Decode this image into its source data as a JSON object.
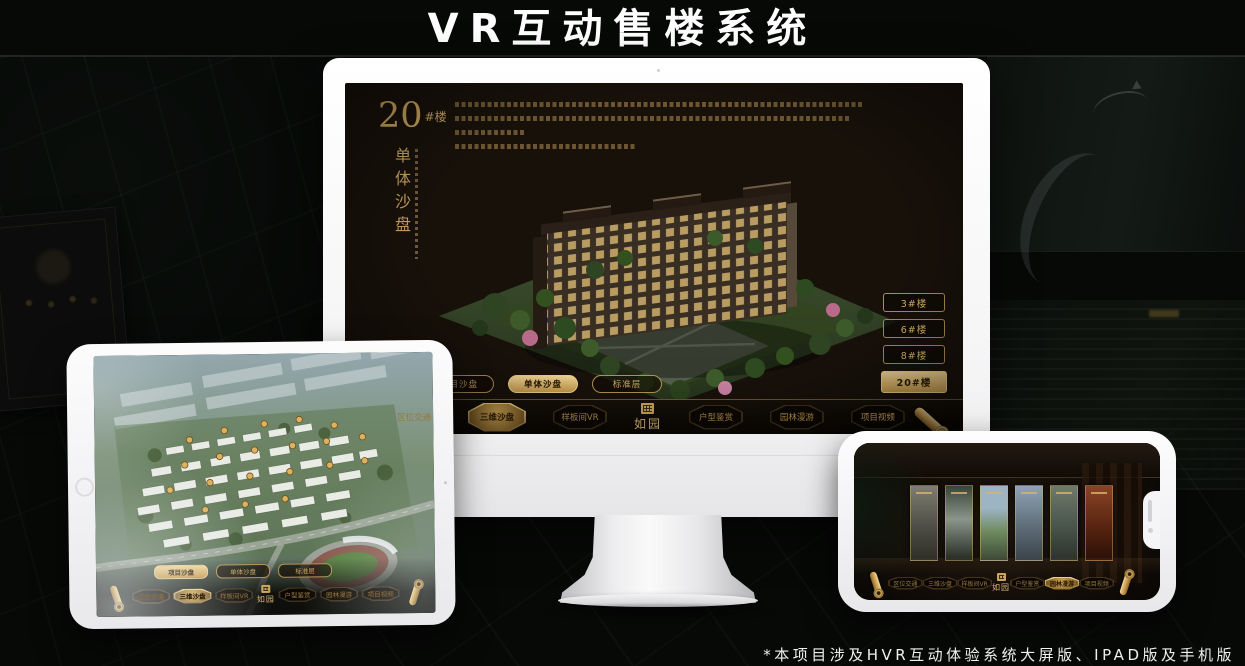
{
  "page": {
    "title": "VR互动售楼系统",
    "footnote": "*本项目涉及HVR互动体验系统大屏版、IPAD版及手机版"
  },
  "colors": {
    "gold": "#c9a45f",
    "gold_bright": "#ecd28c",
    "selected_gold_bg": "#d9b469",
    "screen_bg": "#18110a",
    "title_text": "#ffffff"
  },
  "icons": {
    "nav_end": "scroll-icon",
    "logo": "seal-icon",
    "tablet_home": "home-button",
    "camera": "camera-dot",
    "notch_speaker": "speaker-slit"
  },
  "desktop_screen": {
    "building_number": "20",
    "building_number_suffix": "#楼",
    "vertical_title": "单体沙盘",
    "building_buttons": [
      {
        "label": "3#楼"
      },
      {
        "label": "6#楼"
      },
      {
        "label": "8#楼"
      },
      {
        "label": "20#楼",
        "selected": true
      }
    ],
    "sub_tabs": [
      {
        "label": "项目沙盘"
      },
      {
        "label": "单体沙盘",
        "selected": true
      },
      {
        "label": "标准层"
      }
    ],
    "nav": {
      "logo": "如园",
      "items": [
        {
          "label": "区位交通"
        },
        {
          "label": "三维沙盘",
          "selected": true
        },
        {
          "label": "样板间VR"
        },
        {
          "label": "户型鉴赏"
        },
        {
          "label": "园林漫游"
        },
        {
          "label": "项目视频"
        }
      ]
    }
  },
  "tablet_screen": {
    "sub_tabs": [
      {
        "label": "项目沙盘",
        "selected": true
      },
      {
        "label": "单体沙盘"
      },
      {
        "label": "标准层"
      }
    ],
    "nav": {
      "logo": "如园",
      "items": [
        {
          "label": "区位交通"
        },
        {
          "label": "三维沙盘",
          "selected": true
        },
        {
          "label": "样板间VR"
        },
        {
          "label": "户型鉴赏"
        },
        {
          "label": "园林漫游"
        },
        {
          "label": "项目视频"
        }
      ]
    }
  },
  "phone_screen": {
    "nav": {
      "logo": "如园",
      "items": [
        {
          "label": "区位交通"
        },
        {
          "label": "三维沙盘"
        },
        {
          "label": "样板间VR"
        },
        {
          "label": "户型鉴赏"
        },
        {
          "label": "园林漫游",
          "selected": true
        },
        {
          "label": "项目视频"
        }
      ]
    }
  }
}
